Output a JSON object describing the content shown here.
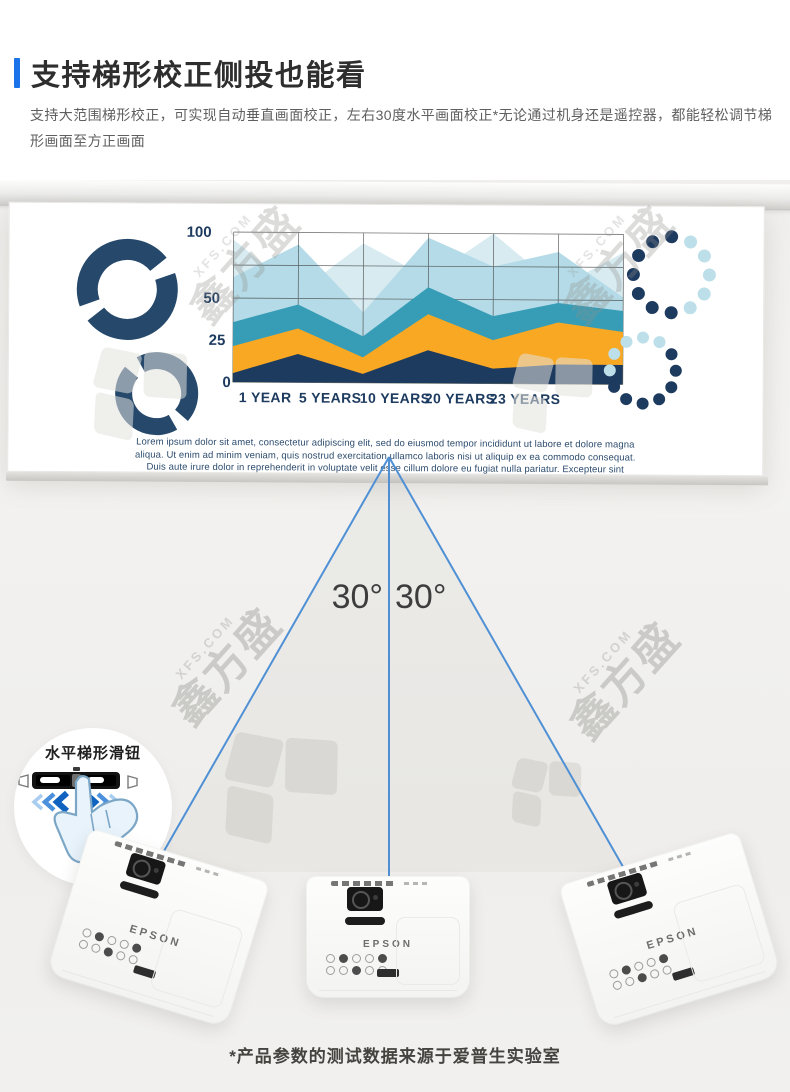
{
  "header": {
    "title": "支持梯形校正侧投也能看",
    "description": "支持大范围梯形校正，可实现自动垂直画面校正，左右30度水平画面校正*无论通过机身还是遥控器，都能轻松调节梯形画面至方正画面",
    "accent_color": "#1a73e8"
  },
  "watermark": {
    "site": "XFS.COM",
    "brand": "鑫方盛"
  },
  "screen": {
    "lorem_lines": [
      "Lorem ipsum dolor sit amet, consectetur adipiscing elit, sed do eiusmod tempor incididunt ut labore et dolore magna",
      "aliqua. Ut enim ad minim veniam, quis nostrud exercitation ullamco laboris nisi ut aliquip ex ea commodo consequat.",
      "Duis aute irure dolor in reprehenderit in voluptate velit esse cillum dolore eu fugiat nulla pariatur. Excepteur sint"
    ]
  },
  "chart_data": {
    "type": "area",
    "title": "",
    "xlabel": "",
    "ylabel": "",
    "categories": [
      "1 YEAR",
      "5 YEARS",
      "10 YEARS",
      "20 YEARS",
      "23 YEARS"
    ],
    "y_ticks": [
      0,
      25,
      50,
      100
    ],
    "y_tick_fractions": [
      0,
      0.28,
      0.56,
      1.0
    ],
    "grid_h_fractions": [
      0,
      0.28,
      0.56,
      0.78,
      1.0
    ],
    "gridlines": true,
    "legend_position": "none",
    "series": [
      {
        "name": "pale-blue",
        "color": "#d7ebf1",
        "values_pct": [
          95,
          60,
          93,
          70,
          100,
          64,
          88
        ]
      },
      {
        "name": "light-blue",
        "color": "#b4dbe7",
        "values_pct": [
          70,
          92,
          47,
          97,
          78,
          88,
          58
        ]
      },
      {
        "name": "teal",
        "color": "#379db6",
        "values_pct": [
          40,
          52,
          31,
          64,
          45,
          54,
          49
        ]
      },
      {
        "name": "orange",
        "color": "#f8a823",
        "values_pct": [
          24,
          36,
          17,
          46,
          29,
          41,
          35
        ]
      },
      {
        "name": "dark-navy",
        "color": "#1d3a5f",
        "values_pct": [
          6,
          19,
          6,
          22,
          10,
          13,
          13
        ]
      }
    ]
  },
  "beam": {
    "left_angle": "30°",
    "right_angle": "30°"
  },
  "callout": {
    "label": "水平梯形滑钮"
  },
  "projector": {
    "brand": "EPSON"
  },
  "footer": {
    "note": "*产品参数的测试数据来源于爱普生实验室"
  },
  "palette": {
    "navy": "#1d3a5f",
    "pale_blue": "#bcdfe9",
    "ring_navy": "#25486b",
    "beam_blue": "#4f90d5",
    "accent_blue": "#1a73e8"
  }
}
